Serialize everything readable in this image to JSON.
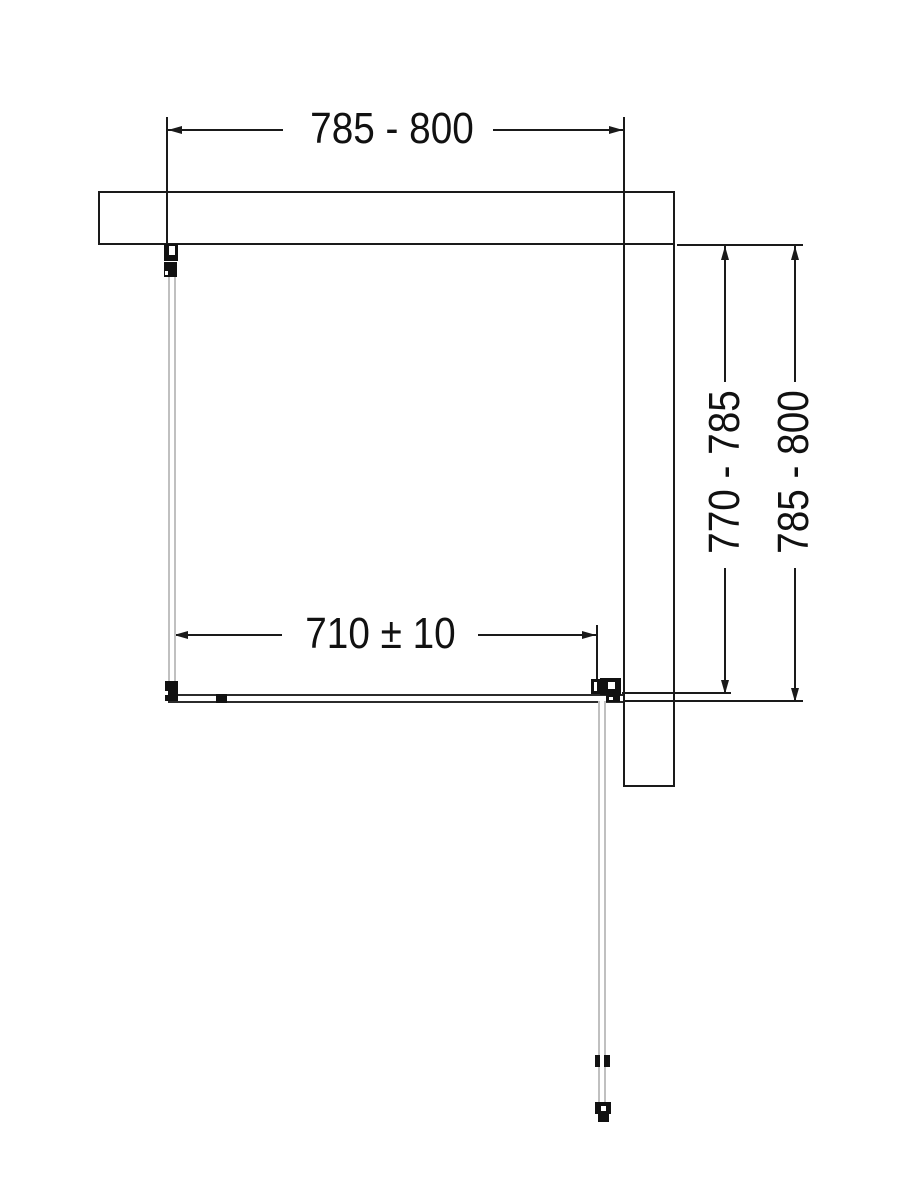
{
  "page": {
    "kind": "technical-dimension-drawing",
    "subject": "shower-enclosure-plan-view",
    "background": "#ffffff"
  },
  "colors": {
    "line": "#1a1a1a",
    "glass": "#c0c0c0",
    "track": "#2b2b2b",
    "hardware": "#111111"
  },
  "dimensions": {
    "top_width_label": "785 - 800",
    "door_width_label": "710 ± 10",
    "depth_inner_label": "770 - 785",
    "depth_outer_label": "785 - 800"
  }
}
